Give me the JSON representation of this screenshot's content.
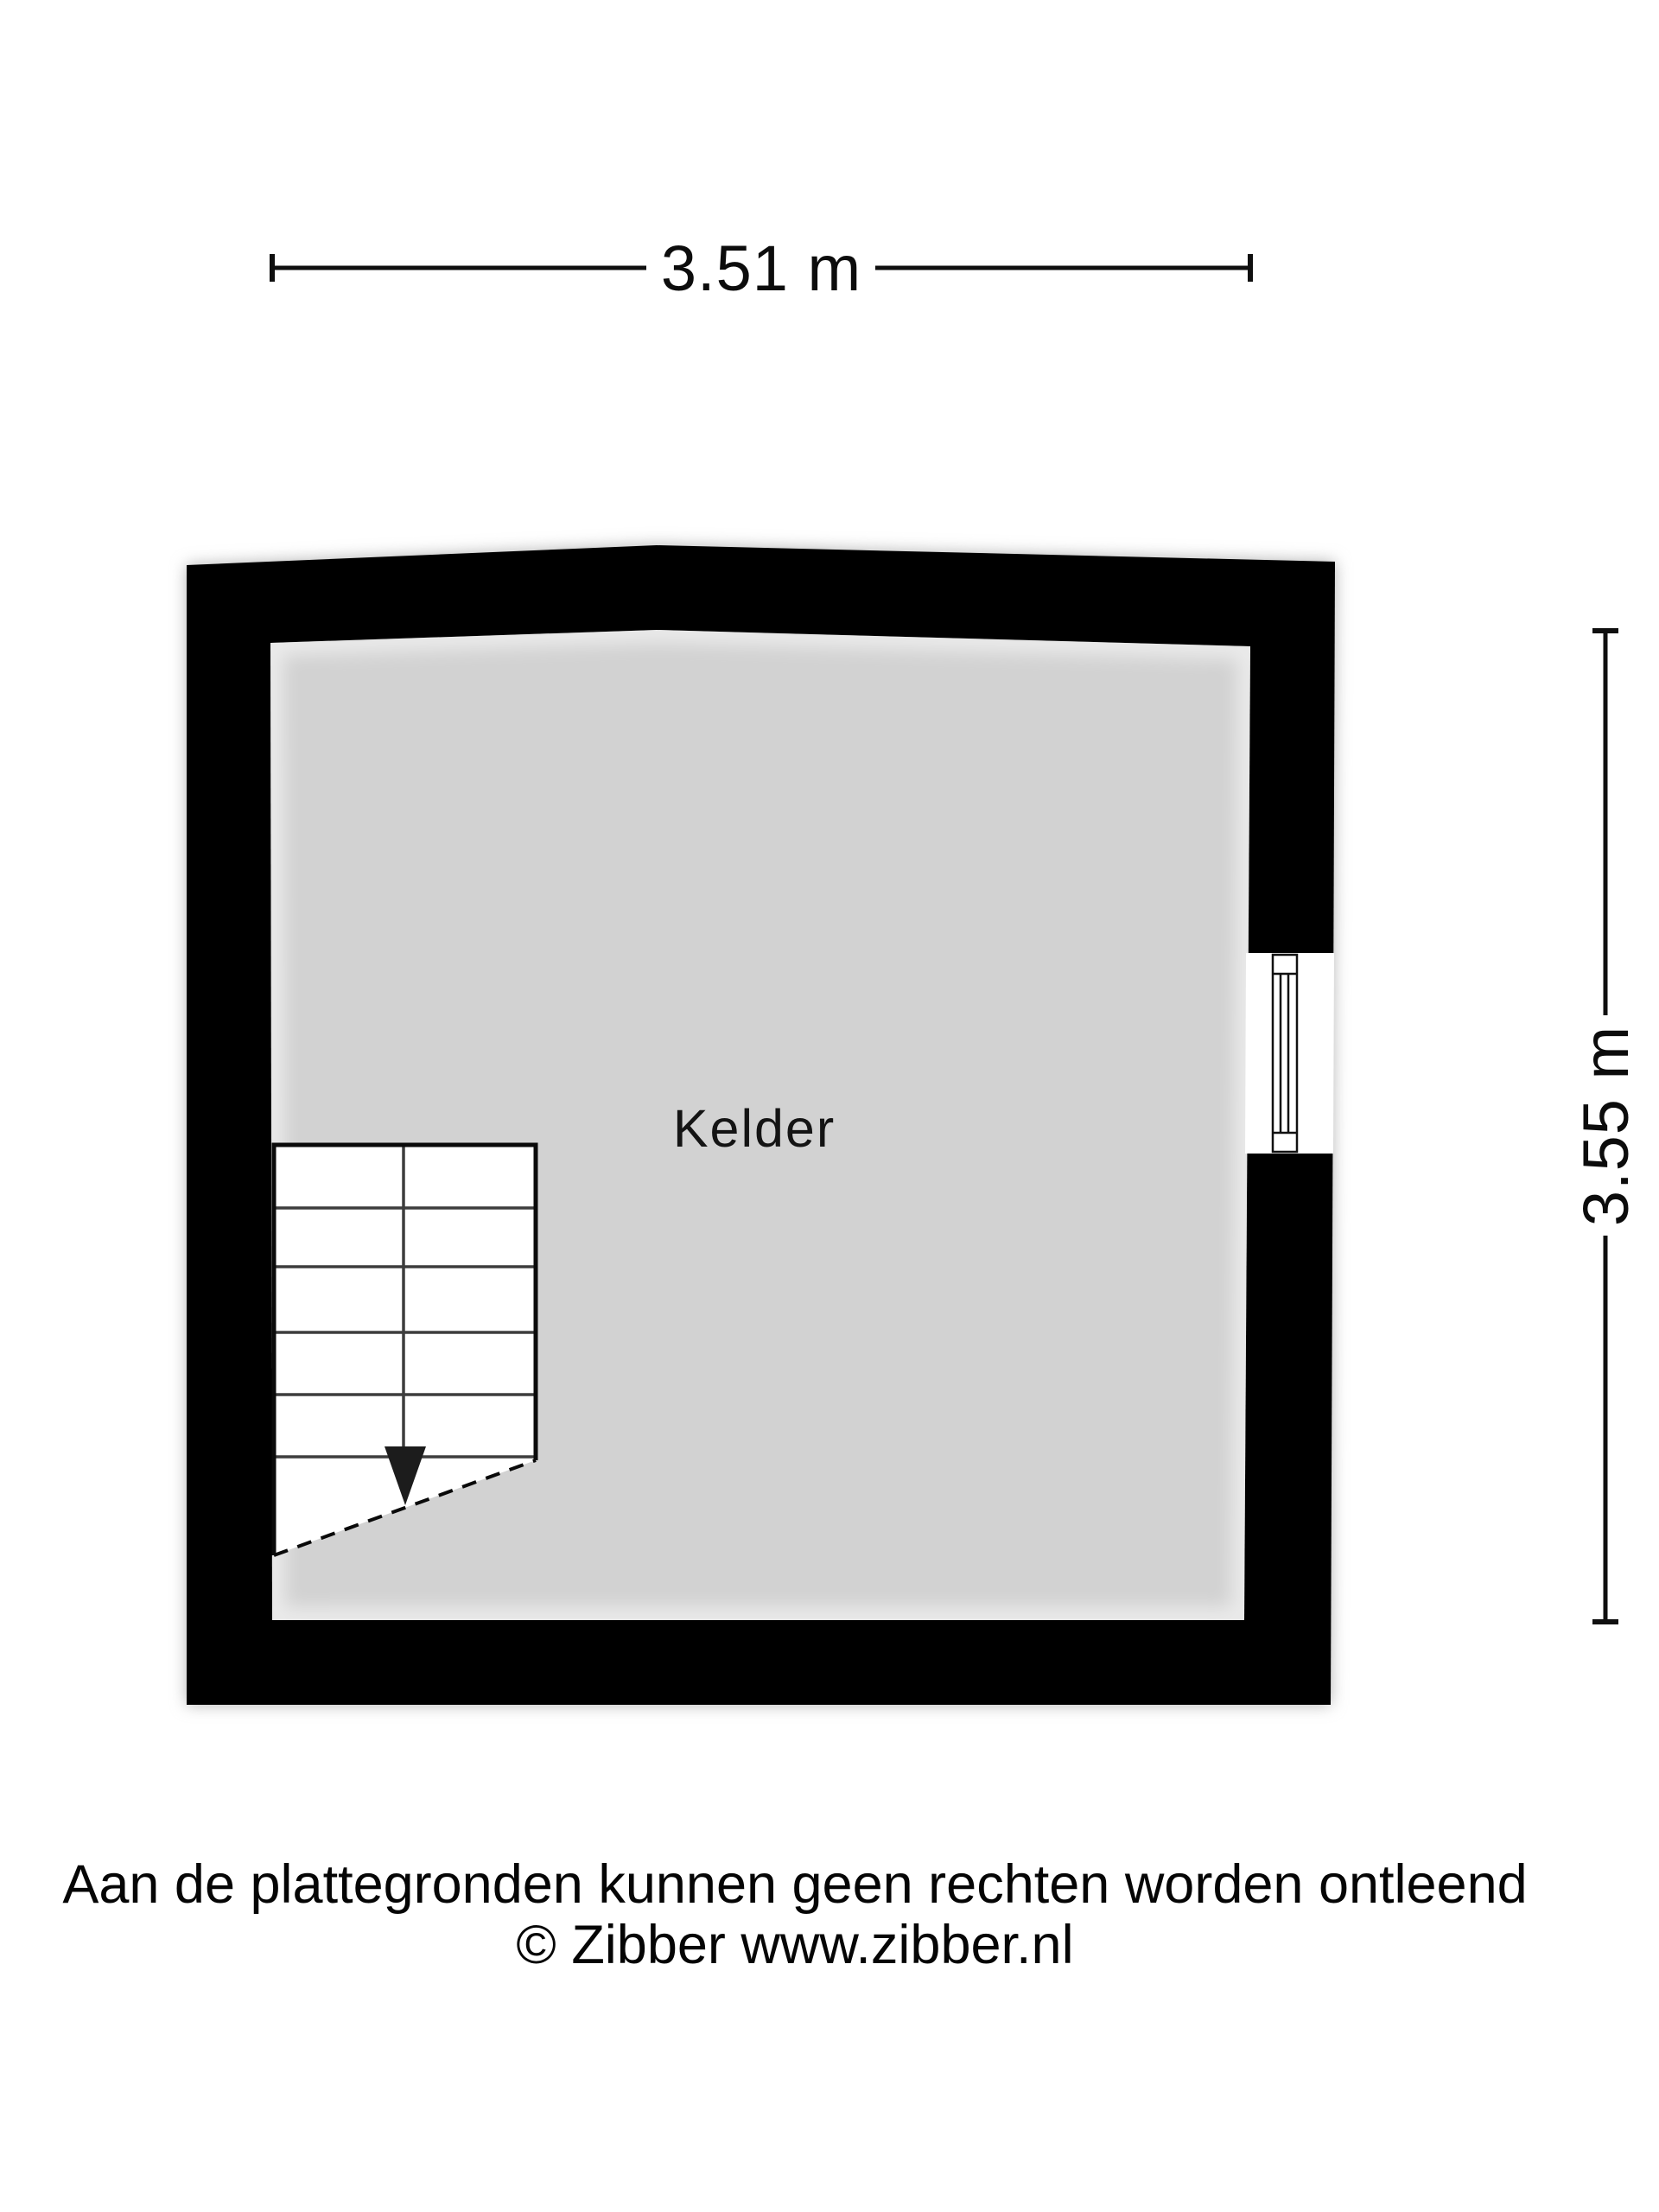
{
  "floor_plan": {
    "room_label": "Kelder",
    "width_dimension": "3.51 m",
    "height_dimension": "3.55 m",
    "colors": {
      "wall": "#000000",
      "floor": "#d2d2d2",
      "stair_fill": "#ffffff",
      "line": "#0f0f0f"
    }
  },
  "footer": {
    "disclaimer": "Aan de plattegronden kunnen geen rechten worden ontleend",
    "copyright": "© Zibber www.zibber.nl"
  }
}
